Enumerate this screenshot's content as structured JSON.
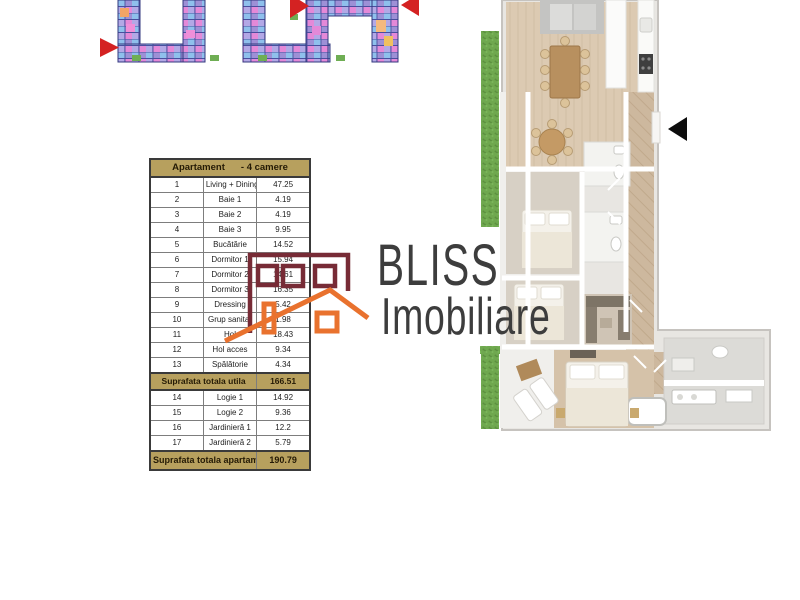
{
  "palette": {
    "tan": "#b7a05e",
    "maroon": "#772b36",
    "orange": "#e9722e",
    "arrow_red": "#d42222",
    "arrow_black": "#0d0d0d",
    "text_dark": "#1e1e1e",
    "grass_green": "#6fa84f",
    "wood_floor": "#dccab2"
  },
  "site_plan": {
    "marker_left": "red-triangle-pointing-right",
    "marker_top": "red-triangle-pointing-right",
    "marker_right": "red-triangle-pointing-left"
  },
  "table": {
    "title": "Apartament",
    "subtitle": "- 4 camere",
    "rows": [
      {
        "nr": "1",
        "name": "Living + Dining",
        "value": "47.25"
      },
      {
        "nr": "2",
        "name": "Baie 1",
        "value": "4.19"
      },
      {
        "nr": "3",
        "name": "Baie 2",
        "value": "4.19"
      },
      {
        "nr": "4",
        "name": "Baie 3",
        "value": "9.95"
      },
      {
        "nr": "5",
        "name": "Bucătărie",
        "value": "14.52"
      },
      {
        "nr": "6",
        "name": "Dormitor 1",
        "value": "15.94"
      },
      {
        "nr": "7",
        "name": "Dormitor 2",
        "value": "14.61"
      },
      {
        "nr": "8",
        "name": "Dormitor 3",
        "value": "16.35"
      },
      {
        "nr": "9",
        "name": "Dressing",
        "value": "5.42"
      },
      {
        "nr": "10",
        "name": "Grup sanitar",
        "value": "1.98"
      },
      {
        "nr": "11",
        "name": "Hol",
        "value": "18.43"
      },
      {
        "nr": "12",
        "name": "Hol acces",
        "value": "9.34"
      },
      {
        "nr": "13",
        "name": "Spălătorie",
        "value": "4.34"
      }
    ],
    "subtotal": {
      "label": "Suprafata totala utila",
      "value": "166.51"
    },
    "rows_annex": [
      {
        "nr": "14",
        "name": "Logie 1",
        "value": "14.92"
      },
      {
        "nr": "15",
        "name": "Logie 2",
        "value": "9.36"
      },
      {
        "nr": "16",
        "name": "Jardinieră 1",
        "value": "12.2"
      },
      {
        "nr": "17",
        "name": "Jardinieră 2",
        "value": "5.79"
      }
    ],
    "total": {
      "label": "Suprafata totala apartament",
      "value": "190.79"
    }
  },
  "watermark": {
    "brand": "BLISS",
    "brand2": "Imobiliare",
    "logo": "house-outline-logo-icon"
  },
  "floor_plan": {
    "entrance_marker": "black-triangle-pointing-left"
  }
}
